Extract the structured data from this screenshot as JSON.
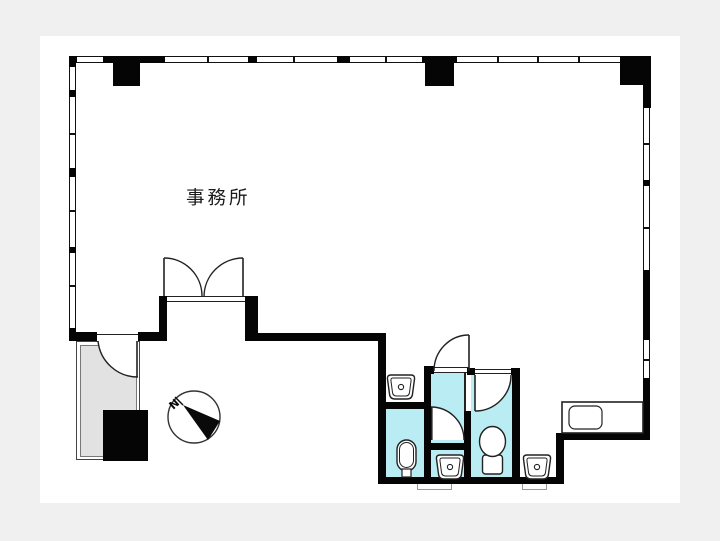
{
  "plan": {
    "room_label": "事務所",
    "compass_north": "N",
    "colors": {
      "page_background": "#f0f0f0",
      "paper": "#ffffff",
      "wall": "#050505",
      "wet_area_fill": "#b9edf3",
      "utility_fill": "#e2e2e2",
      "line": "#222222"
    },
    "rooms": [
      {
        "name": "office",
        "label": "事務所"
      },
      {
        "name": "urinal-room",
        "label": ""
      },
      {
        "name": "washroom",
        "label": ""
      },
      {
        "name": "wc-room",
        "label": ""
      },
      {
        "name": "utility-room",
        "label": ""
      }
    ],
    "fixtures": [
      "hand-basin",
      "hand-basin",
      "hand-basin",
      "urinal",
      "toilet",
      "kitchen-counter",
      "compass"
    ]
  }
}
